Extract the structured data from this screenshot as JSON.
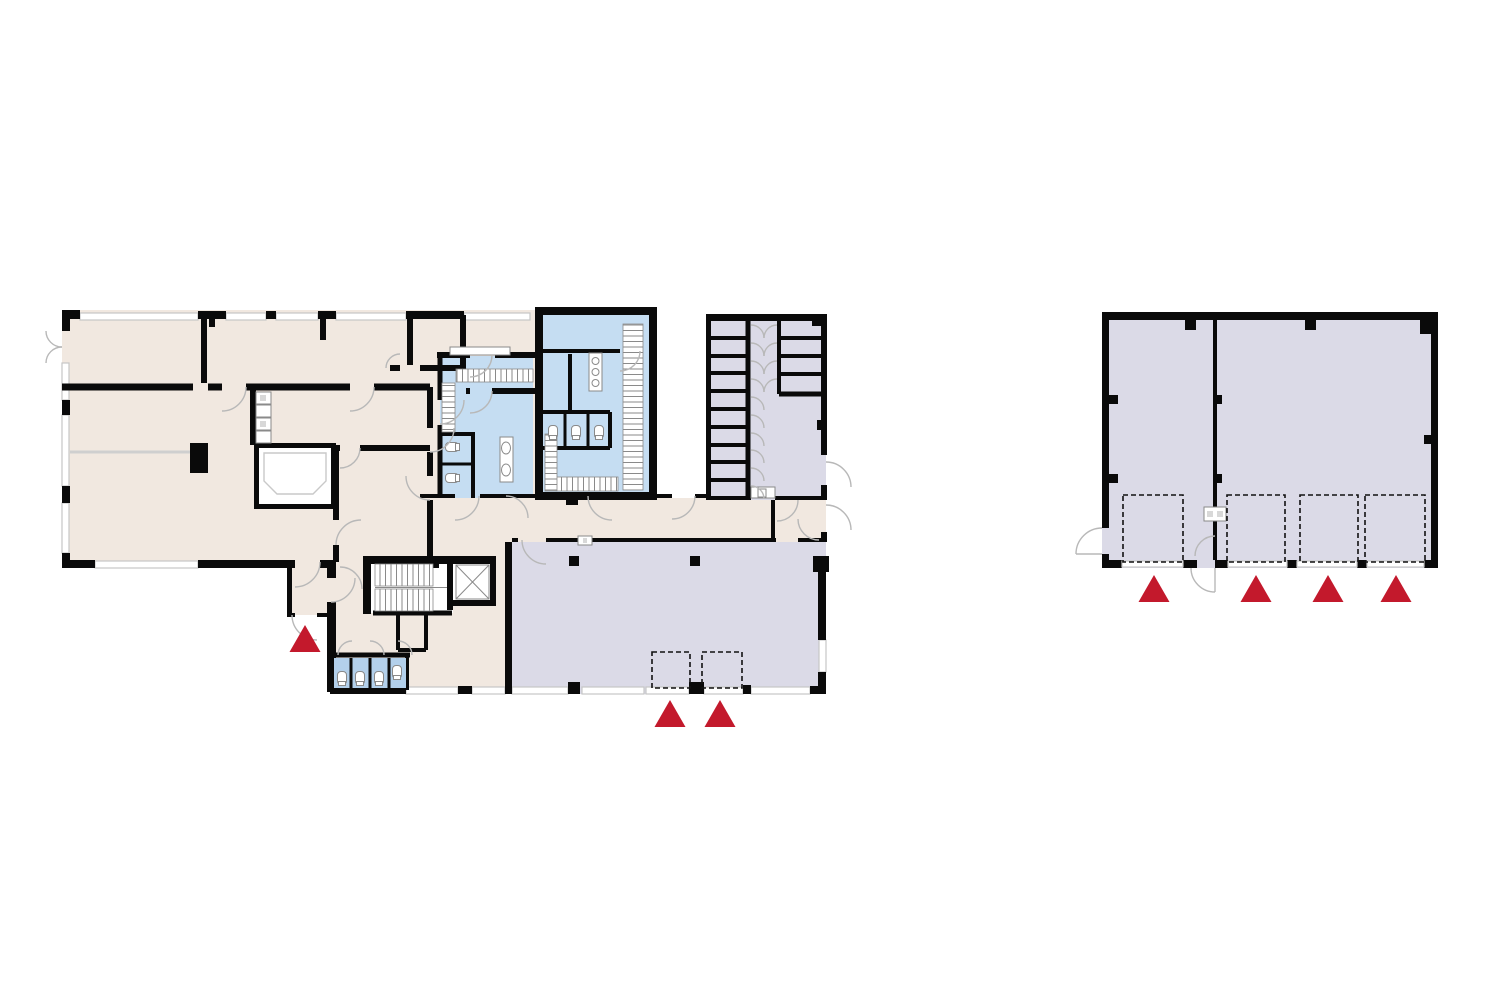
{
  "canvas": {
    "width": 1500,
    "height": 1000,
    "background": "#ffffff"
  },
  "palette": {
    "paper": "#ffffff",
    "wall": "#0a0a0a",
    "room_beige": "#f1e8e0",
    "room_lavender": "#dbdae7",
    "room_blue": "#c5ddf2",
    "fixture_blue": "#b3d0eb",
    "window_line": "#c6c6c6",
    "door_arc": "#b8b8b8",
    "partition": "#cfcfcf",
    "bay_dash": "#111111",
    "entrance_red": "#c3192c"
  },
  "legend": {
    "entrance_marker": "red-triangle-arrow-up",
    "loading_bay": "dashed-rectangle"
  },
  "plans": [
    {
      "id": "left-plan",
      "region": "main building ground floor"
    },
    {
      "id": "right-plan",
      "region": "outbuilding hall"
    }
  ],
  "entrance_arrows": [
    {
      "plan": "left-plan",
      "x": 305,
      "y": 625
    },
    {
      "plan": "left-plan",
      "x": 670,
      "y": 700
    },
    {
      "plan": "left-plan",
      "x": 720,
      "y": 700
    },
    {
      "plan": "right-plan",
      "x": 1154,
      "y": 575
    },
    {
      "plan": "right-plan",
      "x": 1256,
      "y": 575
    },
    {
      "plan": "right-plan",
      "x": 1328,
      "y": 575
    },
    {
      "plan": "right-plan",
      "x": 1396,
      "y": 575
    }
  ],
  "arrow_size": {
    "width": 31,
    "height": 27
  },
  "loading_bays": [
    {
      "plan": "left-plan",
      "x": 652,
      "y": 652,
      "w": 38,
      "h": 36
    },
    {
      "plan": "left-plan",
      "x": 702,
      "y": 652,
      "w": 40,
      "h": 36
    },
    {
      "plan": "right-plan",
      "x": 1123,
      "y": 495,
      "w": 60,
      "h": 67
    },
    {
      "plan": "right-plan",
      "x": 1227,
      "y": 495,
      "w": 58,
      "h": 67
    },
    {
      "plan": "right-plan",
      "x": 1300,
      "y": 495,
      "w": 58,
      "h": 67
    },
    {
      "plan": "right-plan",
      "x": 1365,
      "y": 495,
      "w": 60,
      "h": 67
    }
  ]
}
